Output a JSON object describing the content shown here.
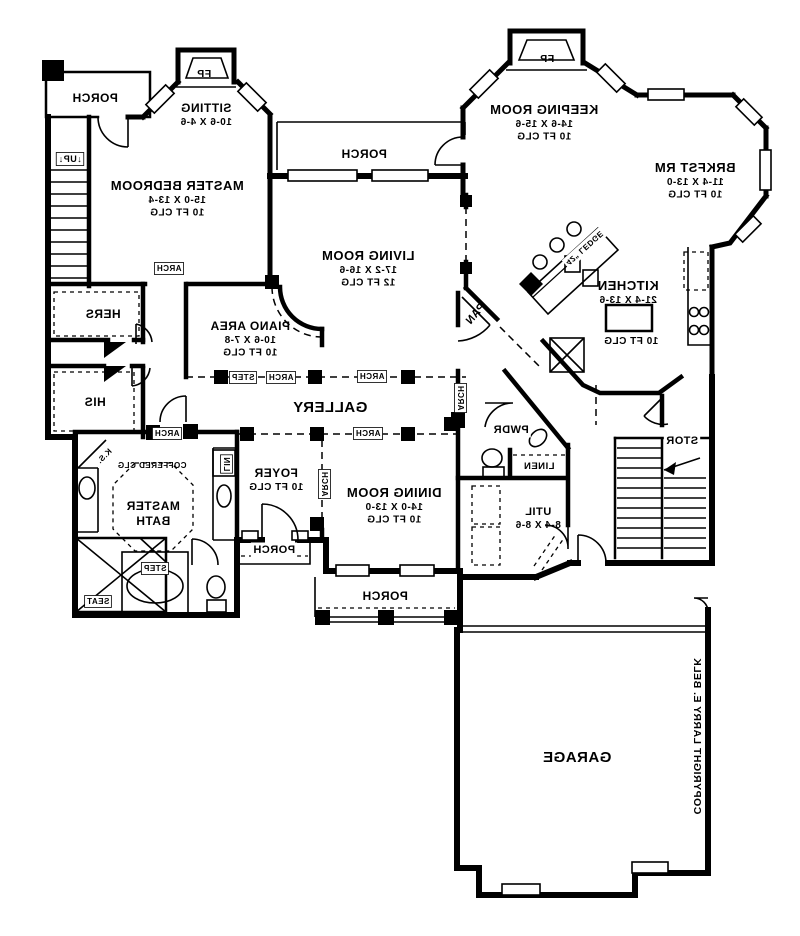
{
  "meta": {
    "title": "Residential first-floor plan (mirror-printed blueprint)",
    "copyright_text": "COPYRIGHT LARRY E. BELK",
    "ink_color": "#000000",
    "paper_color": "#ffffff",
    "mirrored": true
  },
  "rooms": [
    {
      "name": "PORCH (top-left)"
    },
    {
      "name": "SITTING",
      "dims": "10-6 X 4-6"
    },
    {
      "name": "MASTER BEDROOM",
      "dims": "15-0 X 13-4",
      "ceiling": "10 FT CLG"
    },
    {
      "name": "HERS"
    },
    {
      "name": "HIS"
    },
    {
      "name": "PIANO AREA",
      "dims": "10-6 X 7-8",
      "ceiling": "10 FT CLG"
    },
    {
      "name": "LIVING ROOM",
      "dims": "17-2 X 16-6",
      "ceiling": "12 FT CLG"
    },
    {
      "name": "PORCH (top-center)"
    },
    {
      "name": "KEEPING ROOM",
      "dims": "14-6 X 15-6",
      "ceiling": "10 FT CLG"
    },
    {
      "name": "BRKFST RM",
      "dims": "11-4 X 13-0",
      "ceiling": "10 FT CLG"
    },
    {
      "name": "KITCHEN",
      "dims": "21-4 X 13-6",
      "ceiling": "10 FT CLG"
    },
    {
      "name": "PAN"
    },
    {
      "name": "GALLERY"
    },
    {
      "name": "PWDR"
    },
    {
      "name": "LINEN"
    },
    {
      "name": "UTIL",
      "dims": "8-4 X 8-6"
    },
    {
      "name": "STOR"
    },
    {
      "name": "FOYER",
      "ceiling": "10 FT CLG"
    },
    {
      "name": "DINING ROOM",
      "dims": "14-0 X 13-0",
      "ceiling": "10 FT CLG"
    },
    {
      "name": "MASTER BATH",
      "ceiling": "COFFERED CLG"
    },
    {
      "name": "PORCH (front stoop)"
    },
    {
      "name": "PORCH (bottom)"
    },
    {
      "name": "GARAGE"
    }
  ],
  "labels": [
    {
      "id": "porch-top-left",
      "lines": [
        "PORCH"
      ],
      "x": 95,
      "y": 102,
      "size": 12
    },
    {
      "id": "fp-sitting",
      "lines": [
        "FP"
      ],
      "x": 204,
      "y": 77,
      "size": 10.5
    },
    {
      "id": "sitting",
      "lines": [
        "SITTING",
        "10-6 X 4-6"
      ],
      "x": 206,
      "y": 112,
      "size": 12,
      "sub": 10
    },
    {
      "id": "master-bedroom",
      "lines": [
        "MASTER BEDROOM",
        "15-0 X 13-4",
        "10 FT CLG"
      ],
      "x": 177,
      "y": 190,
      "size": 13,
      "sub": 10
    },
    {
      "id": "stairs-up",
      "lines": [
        "↓UP↓"
      ],
      "x": 70,
      "y": 162,
      "size": 9,
      "bg": "box"
    },
    {
      "id": "hers",
      "lines": [
        "HERS"
      ],
      "x": 103,
      "y": 318,
      "size": 12
    },
    {
      "id": "his",
      "lines": [
        "HIS"
      ],
      "x": 95,
      "y": 406,
      "size": 12
    },
    {
      "id": "piano-area",
      "lines": [
        "PIANO AREA",
        "10-6 X 7-8",
        "10 FT CLG"
      ],
      "x": 250,
      "y": 330,
      "size": 12,
      "sub": 10
    },
    {
      "id": "living-room",
      "lines": [
        "LIVING ROOM",
        "17-2 X 16-6",
        "12 FT CLG"
      ],
      "x": 368,
      "y": 260,
      "size": 13,
      "sub": 10
    },
    {
      "id": "porch-top-center",
      "lines": [
        "PORCH"
      ],
      "x": 364,
      "y": 158,
      "size": 12
    },
    {
      "id": "fp-keeping",
      "lines": [
        "FP"
      ],
      "x": 547,
      "y": 62,
      "size": 10.5
    },
    {
      "id": "keeping-room",
      "lines": [
        "KEEPING ROOM",
        "14-6 X 15-6",
        "10 FT CLG"
      ],
      "x": 544,
      "y": 114,
      "size": 13,
      "sub": 10
    },
    {
      "id": "brkfst-rm",
      "lines": [
        "BRKFST RM",
        "11-4 X 13-0",
        "10 FT CLG"
      ],
      "x": 695,
      "y": 172,
      "size": 13,
      "sub": 10
    },
    {
      "id": "ledge-42",
      "lines": [
        "42\" LEDGE"
      ],
      "x": 583,
      "y": 246,
      "size": 8,
      "angle": 138,
      "bg": "white"
    },
    {
      "id": "kitchen",
      "lines": [
        "KITCHEN",
        "21-4 X 13-6"
      ],
      "x": 628,
      "y": 290,
      "size": 13,
      "sub": 10
    },
    {
      "id": "kitchen-clg",
      "lines": [
        "10 FT CLG"
      ],
      "x": 631,
      "y": 344,
      "size": 10
    },
    {
      "id": "pantry",
      "lines": [
        "PAN"
      ],
      "x": 478,
      "y": 316,
      "size": 11,
      "angle": -50
    },
    {
      "id": "gallery",
      "lines": [
        "GALLERY"
      ],
      "x": 330,
      "y": 412,
      "size": 15
    },
    {
      "id": "step-gallery",
      "lines": [
        "STEP"
      ],
      "x": 243,
      "y": 380,
      "size": 8,
      "bg": "box"
    },
    {
      "id": "arch-gallery-1",
      "lines": [
        "ARCH"
      ],
      "x": 281,
      "y": 380,
      "size": 8,
      "bg": "box"
    },
    {
      "id": "arch-gallery-2",
      "lines": [
        "ARCH"
      ],
      "x": 372,
      "y": 379,
      "size": 8,
      "bg": "box"
    },
    {
      "id": "arch-gallery-3",
      "lines": [
        "ARCH"
      ],
      "x": 368,
      "y": 436,
      "size": 8,
      "bg": "box"
    },
    {
      "id": "arch-dining-v",
      "lines": [
        "ARCH"
      ],
      "x": 458,
      "y": 398,
      "size": 8,
      "orient": "v",
      "bg": "box"
    },
    {
      "id": "arch-foyer-v",
      "lines": [
        "ARCH"
      ],
      "x": 322,
      "y": 484,
      "size": 8,
      "orient": "v",
      "bg": "box"
    },
    {
      "id": "arch-bath-hall",
      "lines": [
        "ARCH"
      ],
      "x": 167,
      "y": 436,
      "size": 8,
      "bg": "box"
    },
    {
      "id": "arch-bedroom",
      "lines": [
        "ARCH"
      ],
      "x": 169,
      "y": 271,
      "size": 8,
      "bg": "box"
    },
    {
      "id": "pwdr",
      "lines": [
        "PWDR"
      ],
      "x": 511,
      "y": 433,
      "size": 11,
      "bg": "white"
    },
    {
      "id": "linen",
      "lines": [
        "LINEN"
      ],
      "x": 539,
      "y": 469,
      "size": 9.5,
      "bg": "white"
    },
    {
      "id": "util",
      "lines": [
        "UTIL",
        "8-4 X 8-6"
      ],
      "x": 538,
      "y": 515,
      "size": 11,
      "sub": 10
    },
    {
      "id": "stor",
      "lines": [
        "STOR"
      ],
      "x": 682,
      "y": 444,
      "size": 11,
      "bg": "white"
    },
    {
      "id": "foyer",
      "lines": [
        "FOYER",
        "10 FT CLG"
      ],
      "x": 276,
      "y": 477,
      "size": 12,
      "sub": 10
    },
    {
      "id": "dining-room",
      "lines": [
        "DINING ROOM",
        "14-0 X 13-0",
        "10 FT CLG"
      ],
      "x": 394,
      "y": 497,
      "size": 13,
      "sub": 10
    },
    {
      "id": "porch-stoop",
      "lines": [
        "PORCH"
      ],
      "x": 274,
      "y": 553,
      "size": 11,
      "bg": "white"
    },
    {
      "id": "porch-bottom",
      "lines": [
        "PORCH"
      ],
      "x": 385,
      "y": 600,
      "size": 12,
      "bg": "white"
    },
    {
      "id": "coffered-clg",
      "lines": [
        "COFFERED CLG"
      ],
      "x": 152,
      "y": 468,
      "size": 8
    },
    {
      "id": "master-bath",
      "lines": [
        "MASTER",
        "BATH"
      ],
      "x": 153,
      "y": 510,
      "size": 12,
      "sub": 12
    },
    {
      "id": "knee-space",
      "lines": [
        "K.S."
      ],
      "x": 106,
      "y": 458,
      "size": 8,
      "angle": -45
    },
    {
      "id": "seat",
      "lines": [
        "SEAT"
      ],
      "x": 98,
      "y": 604,
      "size": 8,
      "bg": "box"
    },
    {
      "id": "step-tub",
      "lines": [
        "STEP"
      ],
      "x": 155,
      "y": 571,
      "size": 8,
      "bg": "box"
    },
    {
      "id": "lin-cabinet",
      "lines": [
        "LIN"
      ],
      "x": 224,
      "y": 464,
      "size": 8,
      "orient": "v",
      "bg": "box"
    },
    {
      "id": "garage",
      "lines": [
        "GARAGE"
      ],
      "x": 577,
      "y": 762,
      "size": 15
    },
    {
      "id": "copyright",
      "lines": [
        "COPYRIGHT LARRY E. BELK"
      ],
      "x": 694,
      "y": 736,
      "size": 10.5,
      "orient": "v"
    }
  ]
}
